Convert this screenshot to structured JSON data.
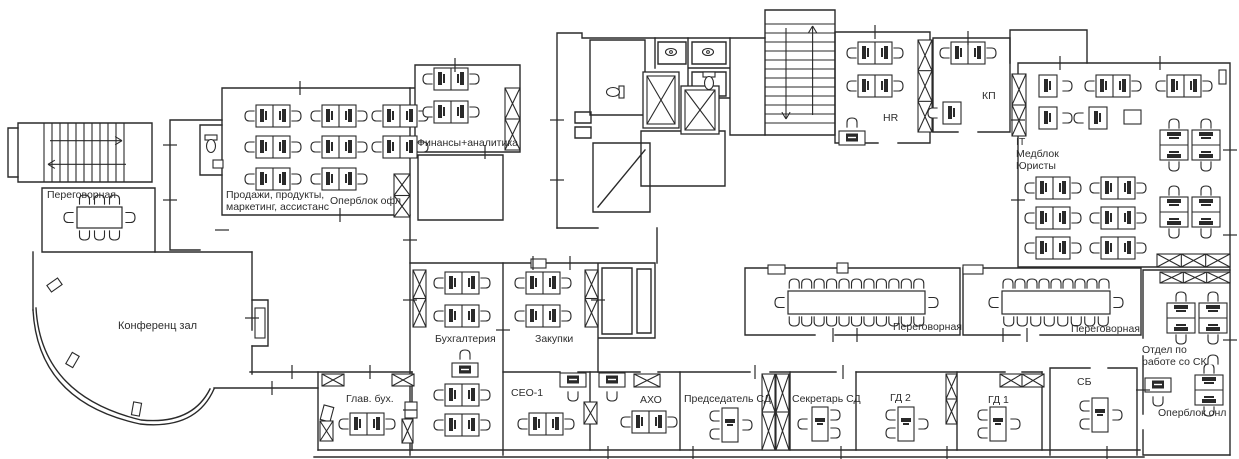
{
  "plan": {
    "title": "Office floor plan",
    "colors": {
      "ink": "#2a2a2a",
      "bg": "#ffffff",
      "label": "#2d2d2d"
    },
    "rooms": [
      {
        "id": "meeting-nw",
        "label": "Переговорная",
        "x": 47,
        "y": 189
      },
      {
        "id": "sales",
        "label": "Продажи, продукты,\nмаркетинг, ассистанс",
        "x": 226,
        "y": 189
      },
      {
        "id": "operblok-ofl",
        "label": "Оперблок офл",
        "x": 330,
        "y": 195
      },
      {
        "id": "finance",
        "label": "Финансы+аналитика",
        "x": 417,
        "y": 137
      },
      {
        "id": "hr",
        "label": "HR",
        "x": 883,
        "y": 112
      },
      {
        "id": "kp",
        "label": "КП",
        "x": 982,
        "y": 90
      },
      {
        "id": "it-med-jur",
        "label": "IT\nМедблок\nЮристы",
        "x": 1016,
        "y": 136
      },
      {
        "id": "conference",
        "label": "Конференц зал",
        "x": 118,
        "y": 320
      },
      {
        "id": "accounting",
        "label": "Бухгалтерия",
        "x": 435,
        "y": 333
      },
      {
        "id": "procurement",
        "label": "Закупки",
        "x": 535,
        "y": 333
      },
      {
        "id": "meeting-1",
        "label": "Переговорная",
        "x": 893,
        "y": 321
      },
      {
        "id": "meeting-2",
        "label": "Переговорная",
        "x": 1071,
        "y": 323
      },
      {
        "id": "otdel-sk",
        "label": "Отдел по\nработе со СК",
        "x": 1142,
        "y": 344
      },
      {
        "id": "glav-buh",
        "label": "Глав. бух.",
        "x": 346,
        "y": 393
      },
      {
        "id": "ceo-1",
        "label": "СЕО-1",
        "x": 511,
        "y": 387
      },
      {
        "id": "aho",
        "label": "АХО",
        "x": 640,
        "y": 394
      },
      {
        "id": "predsedatel-sd",
        "label": "Председатель СД",
        "x": 684,
        "y": 393
      },
      {
        "id": "sekretar-sd",
        "label": "Секретарь СД",
        "x": 792,
        "y": 393
      },
      {
        "id": "gd-2",
        "label": "ГД 2",
        "x": 890,
        "y": 392
      },
      {
        "id": "gd-1",
        "label": "ГД 1",
        "x": 988,
        "y": 394
      },
      {
        "id": "sb",
        "label": "СБ",
        "x": 1077,
        "y": 376
      },
      {
        "id": "operblok-onl",
        "label": "Оперблок онл",
        "x": 1158,
        "y": 407
      }
    ],
    "walls": [
      "M18,123 H152 V182 H18 Z",
      "M18,128 H8 V177 H18",
      "M42,188 H155 V252 H42 Z",
      "M155,252 H252",
      "M33,252 V310",
      "M33,310 Q38,402 140,424 Q196,430 214,389",
      "M36,308 Q41,396 141,420 Q192,425 210,389",
      "M252,252 V330 M252,346 V374",
      "M252,300 H268 V346 H252",
      "M214,388 H318",
      "M222,88 H410 V215 H222 Z",
      "M200,125 H222 M200,175 H222 M200,125 V175",
      "M170,120 H222 M170,120 V250 M170,250 H200",
      "M410,88 H415 M415,65 H520 V152 H415 V65",
      "M418,155 H503 V220 H418 Z",
      "M410,215 V455",
      "M557,33 V228 M557,33 H582 V38 H765",
      "M765,10 H835 V135 H765 Z",
      "M590,40 H645 V115 H590 Z",
      "M655,38 V68 M688,38 V98 M730,38 V135 M688,68 H730 M688,98 H730 M730,135 H765",
      "M658,42 H686 V64 H658 Z M692,42 H726 V64 H692 Z M692,72 H726 V96 H692 Z",
      "M593,143 H650 V212 H593 Z M598,207 L645,150",
      "M641,131 H725 V186 H641 Z",
      "M835,32 H930 M930,32 V143 M835,32 V143 M835,143 H878 M898,143 H930",
      "M933,38 H1010 V132 M933,38 V132 M933,132 H958 M978,132 H1010",
      "M1010,30 H1087 V63 M1010,30 V63",
      "M1018,63 H1230 M1230,63 V455 M1018,63 V267 M1018,267 H1230",
      "M745,268 H960 V335 M745,268 V335 M745,335 H815 M835,335 H960",
      "M963,268 H1141 V335 M963,268 V335 M963,335 H1020 M1040,335 H1141",
      "M1143,270 H1230 M1143,270 V338 M1143,356 V414 M1143,430 V455 M1143,455 H1230",
      "M250,372 H412 M503,372 H560 M578,372 H640 M658,372 H750 M770,372 H836 M856,372 H1005 M1022,372 H1042",
      "M318,372 V450 M412,372 V450 M503,263 V455 M590,372 V450 M680,372 V450 M790,372 V450 M856,372 V450 M957,372 V450 M1042,372 V450",
      "M1050,368 H1090 M1108,368 H1137 M1050,368 V455 M1137,368 V455",
      "M318,450 H1140 M314,457 H1144",
      "M410,263 H598 M598,263 V372 M598,263 H655 V338 H598",
      "M602,268 H632 V334 H602 Z M637,269 H651 V333 H637 Z",
      "M557,228 H598 M657,228 V263",
      "M575,112 H591 V123 H575 Z M575,127 H591 V138 H575 Z"
    ],
    "furniture": {
      "desk_pairs_h": [
        [
          273,
          116
        ],
        [
          339,
          116
        ],
        [
          400,
          116
        ],
        [
          273,
          147
        ],
        [
          339,
          147
        ],
        [
          400,
          147
        ],
        [
          273,
          179
        ],
        [
          339,
          179
        ],
        [
          451,
          79
        ],
        [
          451,
          112
        ],
        [
          875,
          53
        ],
        [
          875,
          86
        ],
        [
          968,
          53
        ],
        [
          1113,
          86
        ],
        [
          1184,
          86
        ],
        [
          1053,
          188
        ],
        [
          1118,
          188
        ],
        [
          1053,
          218
        ],
        [
          1118,
          218
        ],
        [
          1053,
          248
        ],
        [
          1118,
          248
        ],
        [
          462,
          283
        ],
        [
          462,
          316
        ],
        [
          462,
          395
        ],
        [
          462,
          425
        ],
        [
          543,
          283
        ],
        [
          543,
          316
        ],
        [
          367,
          424
        ],
        [
          546,
          424
        ],
        [
          649,
          422
        ]
      ],
      "desk_pairs_v": [
        [
          1174,
          145
        ],
        [
          1206,
          145
        ],
        [
          1174,
          212
        ],
        [
          1206,
          212
        ],
        [
          1181,
          318
        ],
        [
          1213,
          318
        ],
        [
          1209,
          390
        ]
      ],
      "single_desks": [
        [
          1048,
          86,
          "right"
        ],
        [
          1048,
          118,
          "right"
        ],
        [
          1098,
          118,
          "left"
        ],
        [
          952,
          113,
          "left"
        ]
      ],
      "exec_desks": [
        [
          730,
          425,
          "L"
        ],
        [
          906,
          424,
          "L"
        ],
        [
          998,
          424,
          "L"
        ],
        [
          1100,
          415,
          "L"
        ],
        [
          820,
          424,
          "R"
        ]
      ],
      "printers": [
        [
          852,
          138,
          "up"
        ],
        [
          465,
          370,
          "up"
        ],
        [
          573,
          380,
          "down"
        ],
        [
          612,
          380,
          "down"
        ],
        [
          1158,
          385,
          "down"
        ]
      ],
      "loose_chairs": [
        [
          1213,
          360,
          90
        ]
      ],
      "meeting_tables": [
        [
          77,
          207,
          45,
          21,
          3,
          3
        ],
        [
          788,
          291,
          137,
          23,
          11,
          11
        ],
        [
          1002,
          291,
          108,
          23,
          9,
          8
        ]
      ],
      "elevators": [
        [
          643,
          72,
          36,
          56
        ],
        [
          681,
          86,
          38,
          48
        ]
      ],
      "stairs": [
        {
          "x": 18,
          "y": 123,
          "w": 134,
          "h": 59,
          "dir": "h"
        },
        {
          "x": 765,
          "y": 10,
          "w": 70,
          "h": 125,
          "dir": "v"
        }
      ],
      "hatches": [
        [
          918,
          40,
          14,
          92,
          1,
          3
        ],
        [
          1012,
          74,
          14,
          62,
          1,
          2
        ],
        [
          505,
          88,
          15,
          62,
          1,
          2
        ],
        [
          585,
          270,
          13,
          57,
          1,
          2
        ],
        [
          413,
          270,
          13,
          57,
          1,
          2
        ],
        [
          394,
          174,
          16,
          43,
          1,
          2
        ],
        [
          584,
          402,
          13,
          22,
          1,
          1
        ],
        [
          402,
          419,
          11,
          24,
          1,
          1
        ],
        [
          322,
          374,
          22,
          12,
          1,
          1
        ],
        [
          392,
          374,
          22,
          12,
          1,
          1
        ],
        [
          320,
          421,
          13,
          20,
          1,
          1
        ],
        [
          634,
          374,
          26,
          13,
          1,
          1
        ],
        [
          1000,
          374,
          44,
          13,
          2,
          1
        ],
        [
          946,
          374,
          11,
          50,
          1,
          2
        ],
        [
          762,
          374,
          13,
          76,
          1,
          2
        ],
        [
          776,
          374,
          13,
          76,
          1,
          2
        ],
        [
          1157,
          254,
          73,
          13,
          3,
          1
        ],
        [
          1160,
          272,
          70,
          11,
          3,
          1
        ]
      ],
      "toilets": [
        [
          211,
          145,
          0
        ],
        [
          614,
          92,
          90
        ],
        [
          709,
          82,
          0
        ]
      ],
      "sinks": [
        [
          671,
          52
        ],
        [
          708,
          52
        ]
      ],
      "wall_boxes": [
        [
          531,
          259,
          15,
          9,
          0
        ],
        [
          768,
          265,
          17,
          9,
          0
        ],
        [
          837,
          263,
          11,
          10,
          0
        ],
        [
          963,
          265,
          20,
          9,
          0
        ],
        [
          1124,
          110,
          17,
          14,
          0
        ],
        [
          255,
          308,
          10,
          30,
          0
        ],
        [
          48,
          281,
          13,
          8,
          -35
        ],
        [
          66,
          356,
          13,
          8,
          -60
        ],
        [
          130,
          405,
          13,
          8,
          -80
        ],
        [
          213,
          160,
          10,
          8,
          0
        ],
        [
          405,
          402,
          12,
          16,
          0
        ],
        [
          322,
          406,
          10,
          15,
          15
        ],
        [
          1219,
          70,
          7,
          14,
          0
        ]
      ],
      "ticks_v": [
        [
          300,
          88
        ],
        [
          455,
          65
        ],
        [
          485,
          152
        ],
        [
          340,
          215
        ],
        [
          875,
          32
        ],
        [
          968,
          38
        ],
        [
          1060,
          63
        ],
        [
          1160,
          63
        ],
        [
          833,
          335
        ],
        [
          857,
          335
        ],
        [
          1003,
          335
        ],
        [
          1027,
          335
        ],
        [
          755,
          372
        ],
        [
          843,
          372
        ],
        [
          292,
          372
        ],
        [
          370,
          372
        ],
        [
          272,
          388
        ],
        [
          608,
          453
        ],
        [
          693,
          453
        ],
        [
          841,
          453
        ],
        [
          947,
          453
        ],
        [
          1107,
          453
        ],
        [
          533,
          263
        ],
        [
          570,
          263
        ]
      ],
      "ticks_h": [
        [
          170,
          145
        ],
        [
          170,
          200
        ],
        [
          410,
          240
        ],
        [
          410,
          300
        ],
        [
          410,
          410
        ],
        [
          557,
          120
        ],
        [
          557,
          180
        ],
        [
          1230,
          150
        ],
        [
          1230,
          235
        ],
        [
          1230,
          340
        ],
        [
          1143,
          390
        ],
        [
          252,
          318
        ],
        [
          222,
          230
        ],
        [
          503,
          330
        ],
        [
          598,
          300
        ],
        [
          1018,
          120
        ],
        [
          1018,
          200
        ]
      ]
    }
  }
}
